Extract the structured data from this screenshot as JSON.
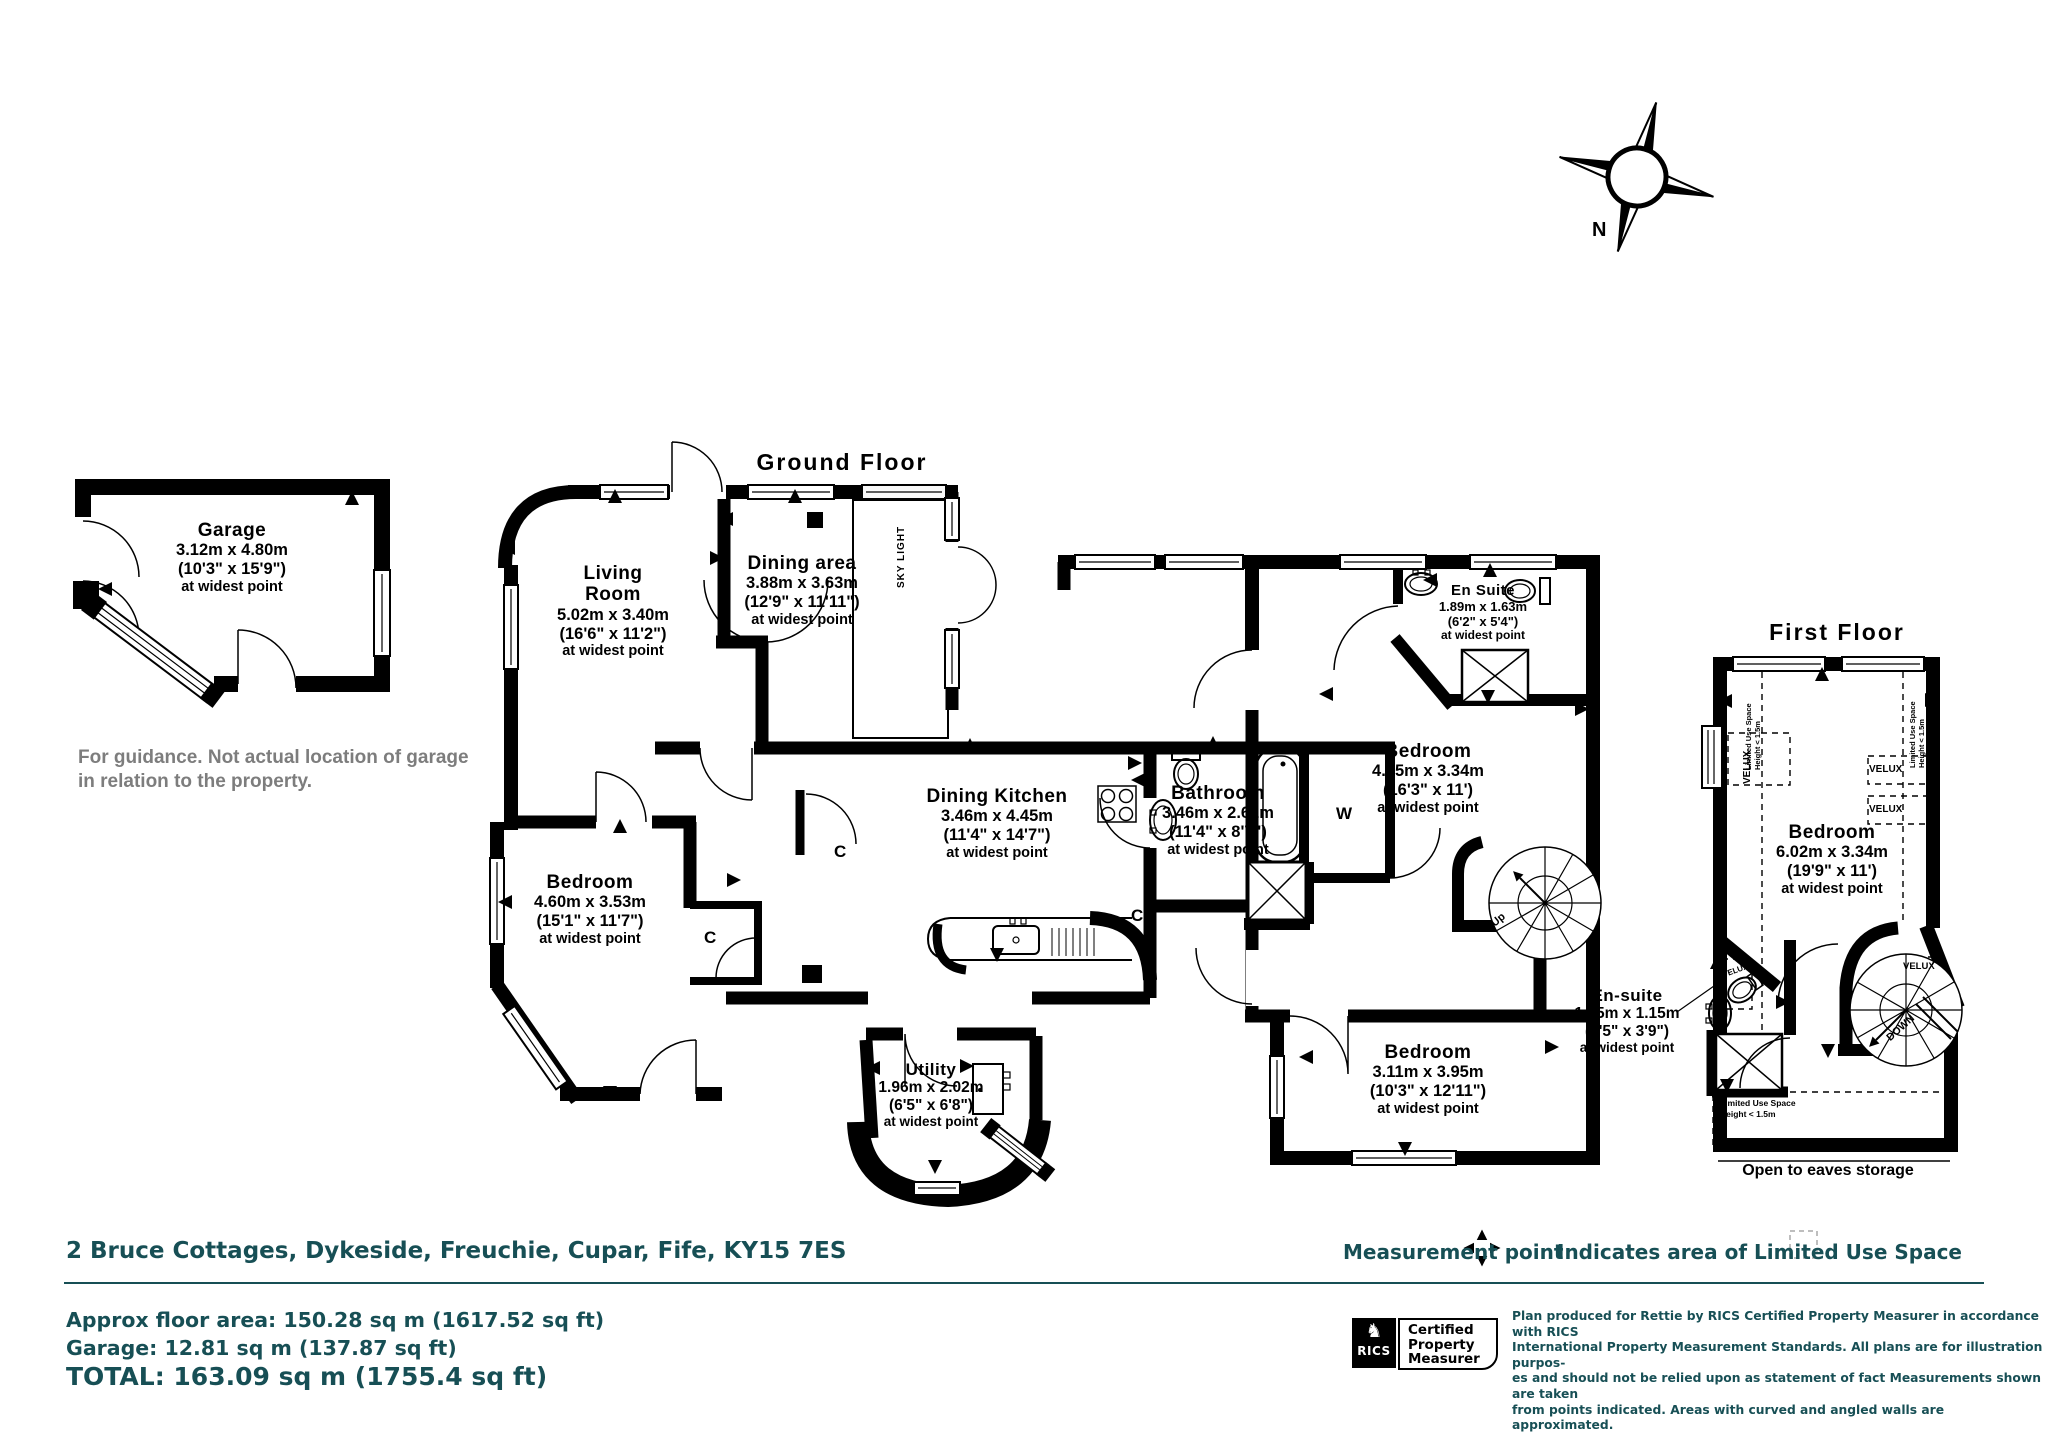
{
  "colors": {
    "accent_teal": "#174F55",
    "guidance_gray": "#7d7d7d",
    "ink": "#000000"
  },
  "icons": {
    "compass": "compass-rose",
    "measurement_point": "four-arrows",
    "rics_emblem": "lion-mark"
  },
  "compass": {
    "north_label": "N"
  },
  "garage": {
    "name": "Garage",
    "m": "3.12m x 4.80m",
    "ft": "(10'3\" x 15'9\")",
    "guidance_1": "For guidance. Not actual location of garage",
    "guidance_2": "in relation to the property."
  },
  "labels": {
    "at_widest": "at widest point",
    "skylight": "SKY LIGHT",
    "cupboard": "C",
    "wardrobe": "W",
    "up": "Up",
    "down": "DOWN",
    "velux": "VELUX",
    "limited_1": "Limited Use Space",
    "limited_2": "Height < 1.5m",
    "eaves": "Open to eaves storage"
  },
  "ground_floor": {
    "title": "Ground Floor",
    "living": {
      "name": "Living Room",
      "m": "5.02m x 3.40m",
      "ft": "(16'6\" x 11'2\")"
    },
    "dining": {
      "name": "Dining area",
      "m": "3.88m x 3.63m",
      "ft": "(12'9\" x 11'11\")"
    },
    "kitchen": {
      "name": "Dining Kitchen",
      "m": "3.46m x 4.45m",
      "ft": "(11'4\" x 14'7\")"
    },
    "bathroom": {
      "name": "Bathroom",
      "m": "3.46m x 2.62m",
      "ft": "(11'4\" x 8'7\")"
    },
    "bedroom_right": {
      "name": "Bedroom",
      "m": "4.95m x 3.34m",
      "ft": "(16'3\" x 11')"
    },
    "ensuite": {
      "name": "En Suite",
      "m": "1.89m x 1.63m",
      "ft": "(6'2\" x 5'4\")"
    },
    "bedroom_left": {
      "name": "Bedroom",
      "m": "4.60m x 3.53m",
      "ft": "(15'1\" x 11'7\")"
    },
    "bedroom_bottom": {
      "name": "Bedroom",
      "m": "3.11m x 3.95m",
      "ft": "(10'3\" x 12'11\")"
    },
    "utility": {
      "name": "Utility",
      "m": "1.96m x 2.02m",
      "ft": "(6'5\" x 6'8\")"
    }
  },
  "first_floor": {
    "title": "First Floor",
    "bedroom": {
      "name": "Bedroom",
      "m": "6.02m x 3.34m",
      "ft": "(19'9\" x 11')"
    },
    "ensuite": {
      "name": "En-suite",
      "m": "1.95m x 1.15m",
      "ft": "(6'5\" x 3'9\")"
    }
  },
  "footer": {
    "address": "2 Bruce Cottages, Dykeside, Freuchie, Cupar, Fife, KY15 7ES",
    "measurement_point": "Measurement point",
    "limited_legend": "Indicates area of Limited Use Space",
    "approx": "Approx floor area: 150.28 sq m (1617.52 sq ft)",
    "garage_area": "Garage: 12.81 sq m (137.87 sq ft)",
    "total": "TOTAL: 163.09 sq m (1755.4 sq ft)",
    "rics_emblem": "♞",
    "rics_name": "RICS",
    "rics_cert": [
      "Certified",
      "Property",
      "Measurer"
    ],
    "legal": [
      "Plan produced for Rettie by RICS Certified Property Measurer in accordance with RICS",
      "International Property  Measurement Standards.  All plans are for illustration purpos-",
      "es and should not be relied upon as statement of fact Measurements shown are taken",
      "from points indicated. Areas with curved and angled walls are approximated."
    ]
  }
}
